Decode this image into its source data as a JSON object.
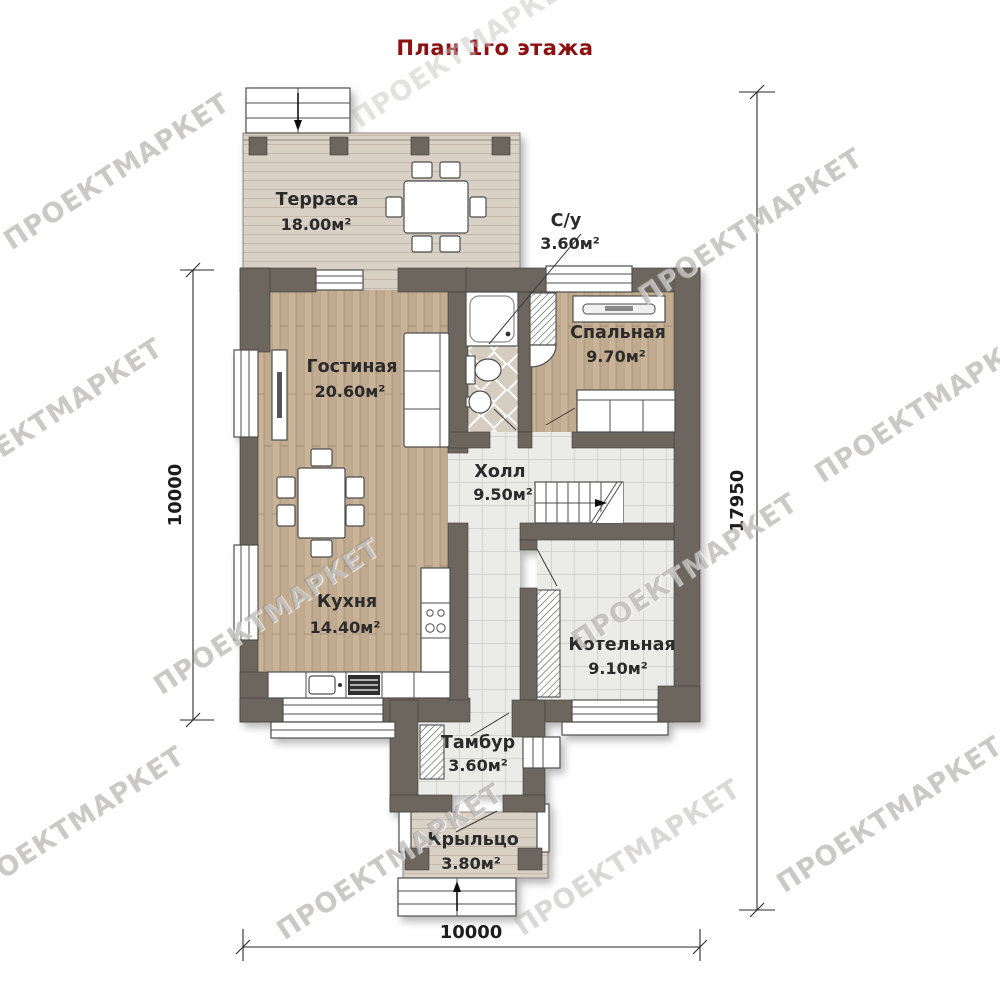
{
  "title": {
    "text": "План 1го этажа"
  },
  "watermark": {
    "text": "ПРОЕКТМАРКЕТ"
  },
  "rooms": [
    {
      "name": "Терраса",
      "area": "18.00м²"
    },
    {
      "name": "С/у",
      "area": "3.60м²"
    },
    {
      "name": "Гостиная",
      "area": "20.60м²"
    },
    {
      "name": "Спальная",
      "area": "9.70м²"
    },
    {
      "name": "Холл",
      "area": "9.50м²"
    },
    {
      "name": "Кухня",
      "area": "14.40м²"
    },
    {
      "name": "Котельная",
      "area": "9.10м²"
    },
    {
      "name": "Тамбур",
      "area": "3.60м²"
    },
    {
      "name": "Крыльцо",
      "area": "3.80м²"
    }
  ],
  "dimensions": {
    "left": "10000",
    "right": "17950",
    "bottom": "10000"
  },
  "colors": {
    "title": "#8c1212",
    "wall": "#6d665e",
    "wood": "#c9b49a",
    "deck": "#dad1c6",
    "tile": "#ebebe8",
    "bathtile": "#d5cdc0",
    "ink": "#2b2b2b"
  }
}
